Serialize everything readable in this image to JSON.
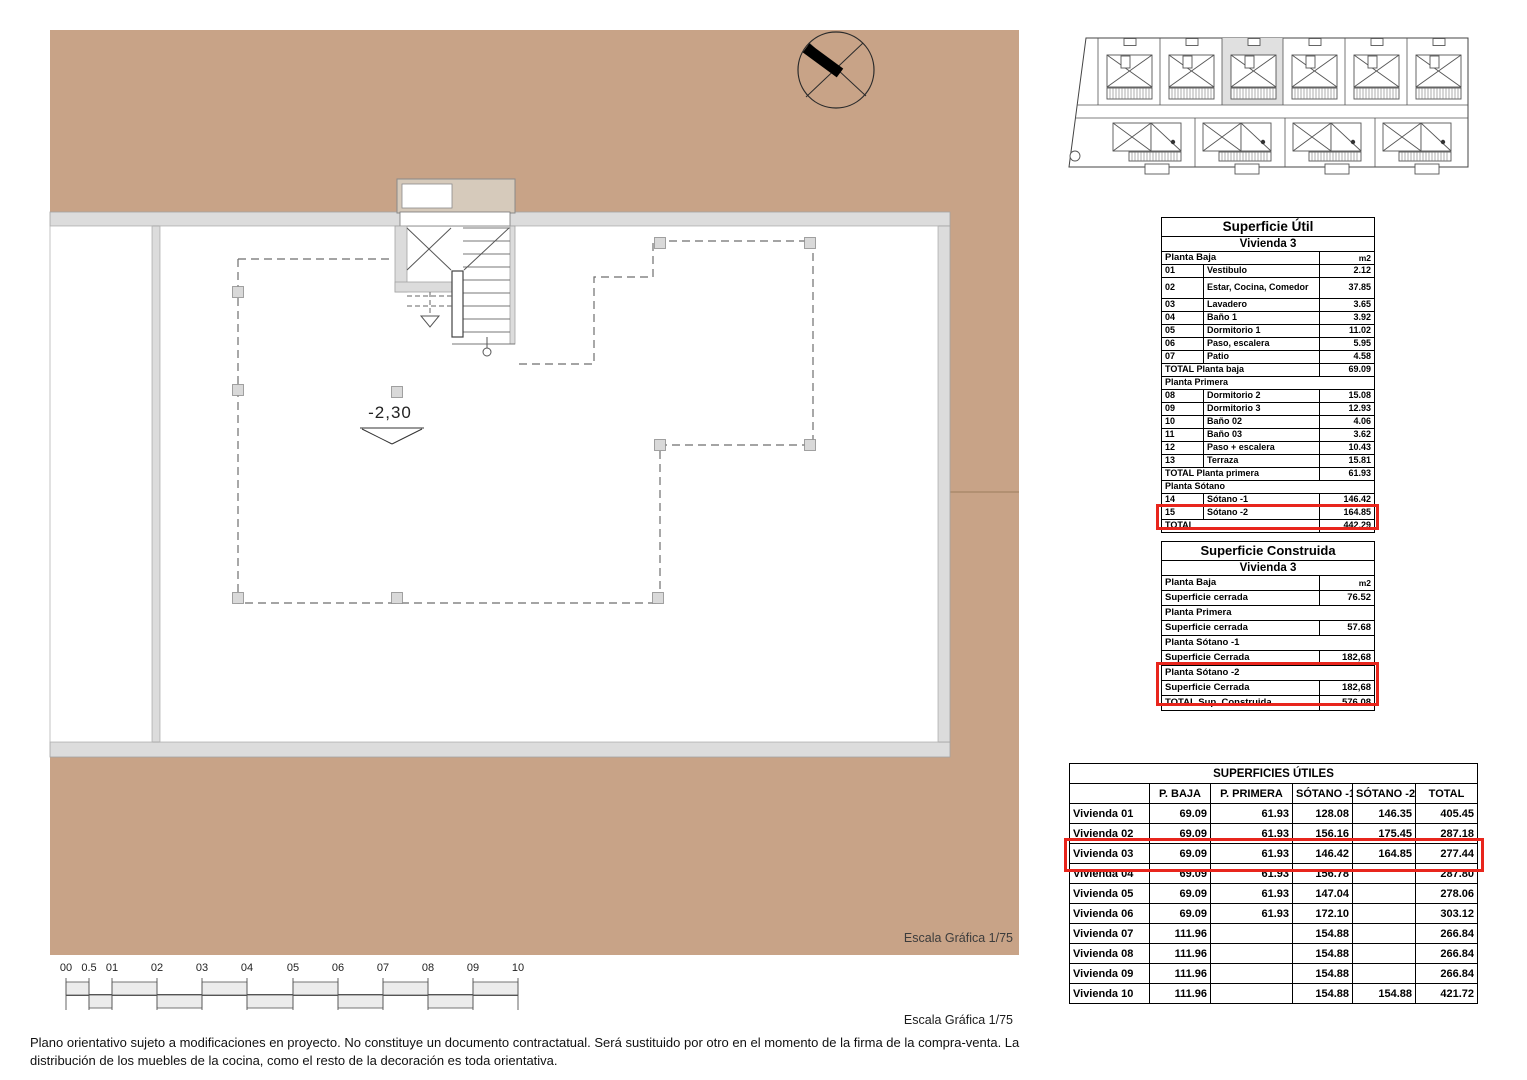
{
  "plan": {
    "level_label": "-2,30",
    "scale_label": "Escala Gráfica 1/75"
  },
  "footer": {
    "scale_label": "Escala Gráfica 1/75",
    "disclaimer_line1": "Plano orientativo sujeto a modificaciones en proyecto. No constituye un documento contractatual. Será sustituido por otro en el momento de la firma de la compra-venta. La",
    "disclaimer_line2": "distribución de los muebles de la cocina, como el resto de la decoración es toda orientativa."
  },
  "scale_bar": {
    "labels": [
      "00",
      "0.5",
      "01",
      "02",
      "03",
      "04",
      "05",
      "06",
      "07",
      "08",
      "09",
      "10"
    ]
  },
  "colors": {
    "terrain": "#c8a387",
    "wall": "#dcdcdc",
    "highlight_red": "#e8251c",
    "site_plot_highlight": "#e0e0e0"
  },
  "tables": {
    "util": {
      "title": "Superficie Útil",
      "subtitle": "Vivienda 3",
      "header": {
        "label": "Planta Baja",
        "unit": "m2"
      },
      "rows": [
        {
          "num": "01",
          "label": "Vestibulo",
          "value": "2.12"
        },
        {
          "num": "02",
          "label": "Estar, Cocina, Comedor",
          "value": "37.85"
        },
        {
          "num": "03",
          "label": "Lavadero",
          "value": "3.65"
        },
        {
          "num": "04",
          "label": "Baño 1",
          "value": "3.92"
        },
        {
          "num": "05",
          "label": "Dormitorio 1",
          "value": "11.02"
        },
        {
          "num": "06",
          "label": "Paso, escalera",
          "value": "5.95"
        },
        {
          "num": "07",
          "label": "Patio",
          "value": "4.58"
        },
        {
          "label": "TOTAL Planta baja",
          "value": "69.09"
        },
        {
          "label": "Planta Primera"
        },
        {
          "num": "08",
          "label": "Dormitorio 2",
          "value": "15.08"
        },
        {
          "num": "09",
          "label": "Dormitorio 3",
          "value": "12.93"
        },
        {
          "num": "10",
          "label": "Baño 02",
          "value": "4.06"
        },
        {
          "num": "11",
          "label": "Baño 03",
          "value": "3.62"
        },
        {
          "num": "12",
          "label": "Paso + escalera",
          "value": "10.43"
        },
        {
          "num": "13",
          "label": "Terraza",
          "value": "15.81"
        },
        {
          "label": "TOTAL Planta primera",
          "value": "61.93"
        },
        {
          "label": "Planta Sótano"
        },
        {
          "num": "14",
          "label": "Sótano -1",
          "value": "146.42"
        },
        {
          "num": "15",
          "label": "Sótano -2",
          "value": "164.85"
        },
        {
          "label": "TOTAL",
          "value": "442.29"
        }
      ]
    },
    "construida": {
      "title": "Superficie Construida",
      "subtitle": "Vivienda 3",
      "header": {
        "label": "Planta Baja",
        "unit": "m2"
      },
      "rows": [
        {
          "label": "Superficie cerrada",
          "value": "76.52"
        },
        {
          "label": "Planta Primera"
        },
        {
          "label": "Superficie cerrada",
          "value": "57.68"
        },
        {
          "label": "Planta Sótano -1"
        },
        {
          "label": "Superficie Cerrada",
          "value": "182,68"
        },
        {
          "label": "Planta Sótano -2"
        },
        {
          "label": "Superficie Cerrada",
          "value": "182,68"
        },
        {
          "label": "TOTAL Sup. Construida",
          "value": "576.08"
        }
      ]
    },
    "viviendas": {
      "title": "SUPERFICIES ÚTILES",
      "columns": [
        "",
        "P. BAJA",
        "P. PRIMERA",
        "SÓTANO -1",
        "SÓTANO -2",
        "TOTAL"
      ],
      "rows": [
        {
          "label": "Vivienda 01",
          "values": [
            "69.09",
            "61.93",
            "128.08",
            "146.35",
            "405.45"
          ]
        },
        {
          "label": "Vivienda 02",
          "values": [
            "69.09",
            "61.93",
            "156.16",
            "175.45",
            "287.18"
          ]
        },
        {
          "label": "Vivienda 03",
          "values": [
            "69.09",
            "61.93",
            "146.42",
            "164.85",
            "277.44"
          ]
        },
        {
          "label": "Vivienda 04",
          "values": [
            "69.09",
            "61.93",
            "156.78",
            "",
            "287.80"
          ]
        },
        {
          "label": "Vivienda 05",
          "values": [
            "69.09",
            "61.93",
            "147.04",
            "",
            "278.06"
          ]
        },
        {
          "label": "Vivienda 06",
          "values": [
            "69.09",
            "61.93",
            "172.10",
            "",
            "303.12"
          ]
        },
        {
          "label": "Vivienda 07",
          "values": [
            "111.96",
            "",
            "154.88",
            "",
            "266.84"
          ]
        },
        {
          "label": "Vivienda 08",
          "values": [
            "111.96",
            "",
            "154.88",
            "",
            "266.84"
          ]
        },
        {
          "label": "Vivienda 09",
          "values": [
            "111.96",
            "",
            "154.88",
            "",
            "266.84"
          ]
        },
        {
          "label": "Vivienda 10",
          "values": [
            "111.96",
            "",
            "154.88",
            "154.88",
            "421.72"
          ]
        }
      ]
    }
  }
}
